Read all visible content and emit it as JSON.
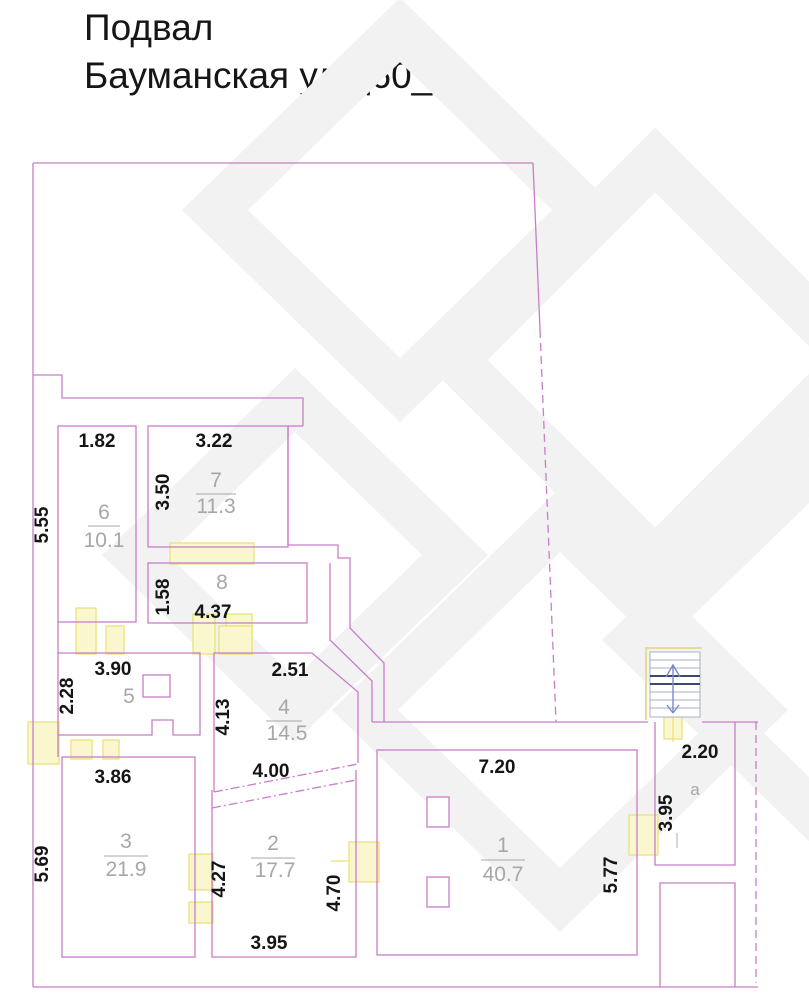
{
  "title": {
    "line1": "Подвал",
    "line2": "Бауманская ул д60_5"
  },
  "plan": {
    "rooms": {
      "r1": {
        "number": "1",
        "area": "40.7",
        "dim_top": "7.20",
        "dim_right": "5.77"
      },
      "r2": {
        "number": "2",
        "area": "17.7",
        "dim_left": "4.27",
        "dim_right": "4.70",
        "dim_bottom": "3.95"
      },
      "r3": {
        "number": "3",
        "area": "21.9",
        "dim_top": "3.86",
        "dim_left": "5.69"
      },
      "r4": {
        "number": "4",
        "area": "14.5",
        "dim_top": "2.51",
        "dim_left": "4.13",
        "dim_bottom": "4.00"
      },
      "r5": {
        "number": "5",
        "dim_top": "3.90",
        "dim_left": "2.28"
      },
      "r6": {
        "number": "6",
        "area": "10.1",
        "dim_top": "1.82",
        "dim_left": "5.55"
      },
      "r7": {
        "number": "7",
        "area": "11.3",
        "dim_top": "3.22",
        "dim_left": "3.50"
      },
      "r8": {
        "number": "8",
        "dim_left": "1.58",
        "dim_bottom": "4.37"
      },
      "ra": {
        "number": "а",
        "dim_top": "2.20",
        "dim_left": "3.95"
      }
    },
    "colors": {
      "wall": "#c87dc8",
      "opening_fill": "#faf7cf",
      "opening_stroke": "#e9e070",
      "dim_text": "#151515",
      "room_text": "#a7a7a7",
      "stair_line": "#a8b0c4",
      "stair_dark": "#3c4a72",
      "stair_arrow": "#7b87cc",
      "watermark": "#f2f2f2"
    }
  }
}
